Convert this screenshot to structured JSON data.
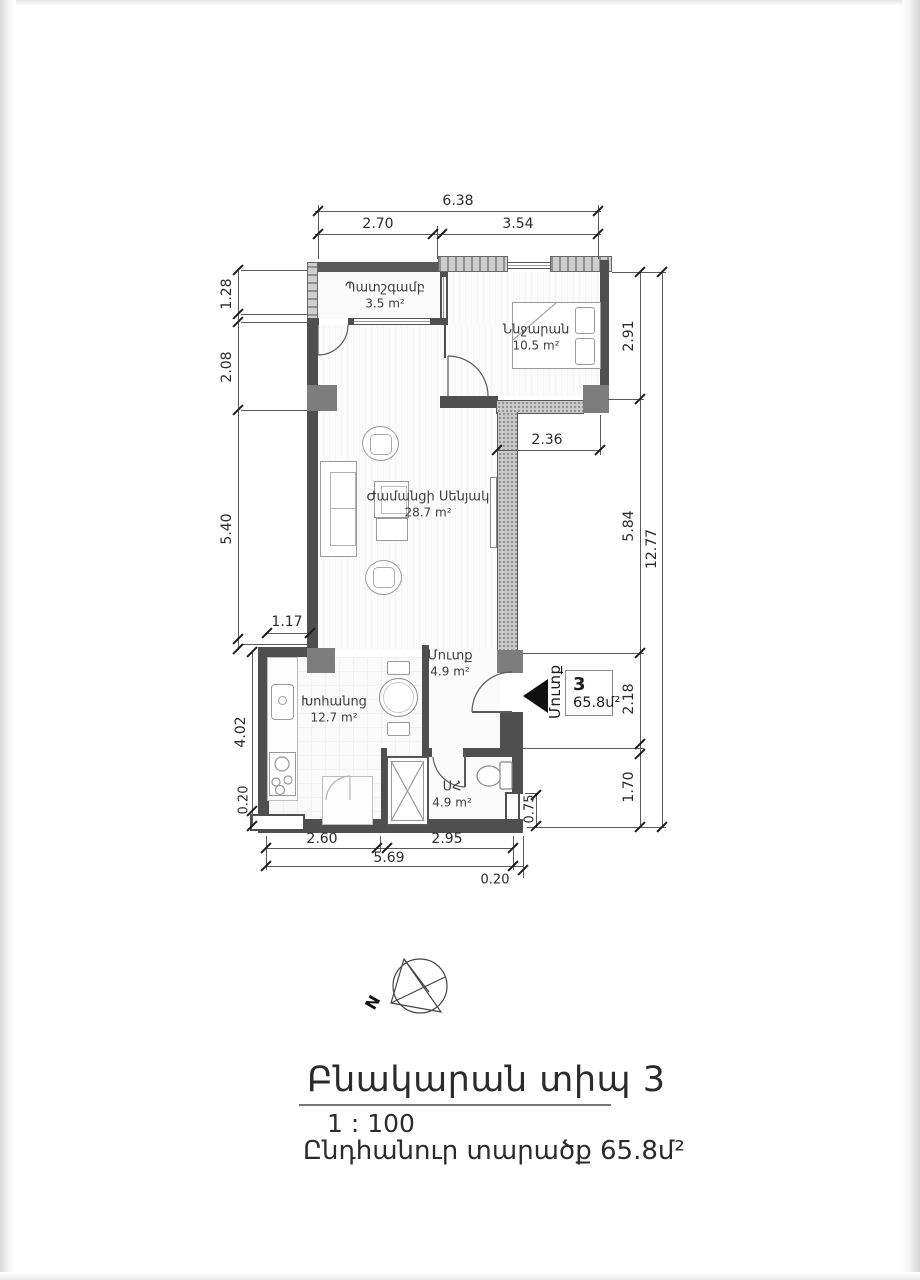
{
  "page": {
    "title": "Բնակարան տիպ 3",
    "scale": "1 : 100",
    "total_area": "Ընդհանուր տարածք 65.8մ²"
  },
  "compass": {
    "north": "N"
  },
  "entrance": {
    "label": "Մուտք",
    "unit_number": "3",
    "unit_area": "65.8մ²"
  },
  "rooms": {
    "balcony": {
      "name": "Պատշգամբ",
      "area": "3.5 m²"
    },
    "bedroom": {
      "name": "Ննջարան",
      "area": "10.5 m²"
    },
    "living": {
      "name": "Ժամանցի Սենյակ",
      "area": "28.7 m²"
    },
    "hall": {
      "name": "Մուտք",
      "area": "4.9 m²"
    },
    "kitchen": {
      "name": "Խոհանոց",
      "area": "12.7 m²"
    },
    "bathroom": {
      "name": "ՍՀ",
      "area": "4.9 m²"
    }
  },
  "dims": {
    "top_total": "6.38",
    "top_a": "2.70",
    "top_b": "3.54",
    "left_a": "1.28",
    "left_b": "2.08",
    "left_c": "5.40",
    "left_d": "4.02",
    "left_e": "0.20",
    "right_a": "2.91",
    "right_b": "5.84",
    "right_c": "2.18",
    "right_d": "1.70",
    "right_total": "12.77",
    "bottom_a": "2.60",
    "bottom_b": "2.95",
    "bottom_total": "5.69",
    "bottom_c": "0.20",
    "inner_a": "2.36",
    "inner_b": "1.17",
    "inner_c": "0.75"
  }
}
